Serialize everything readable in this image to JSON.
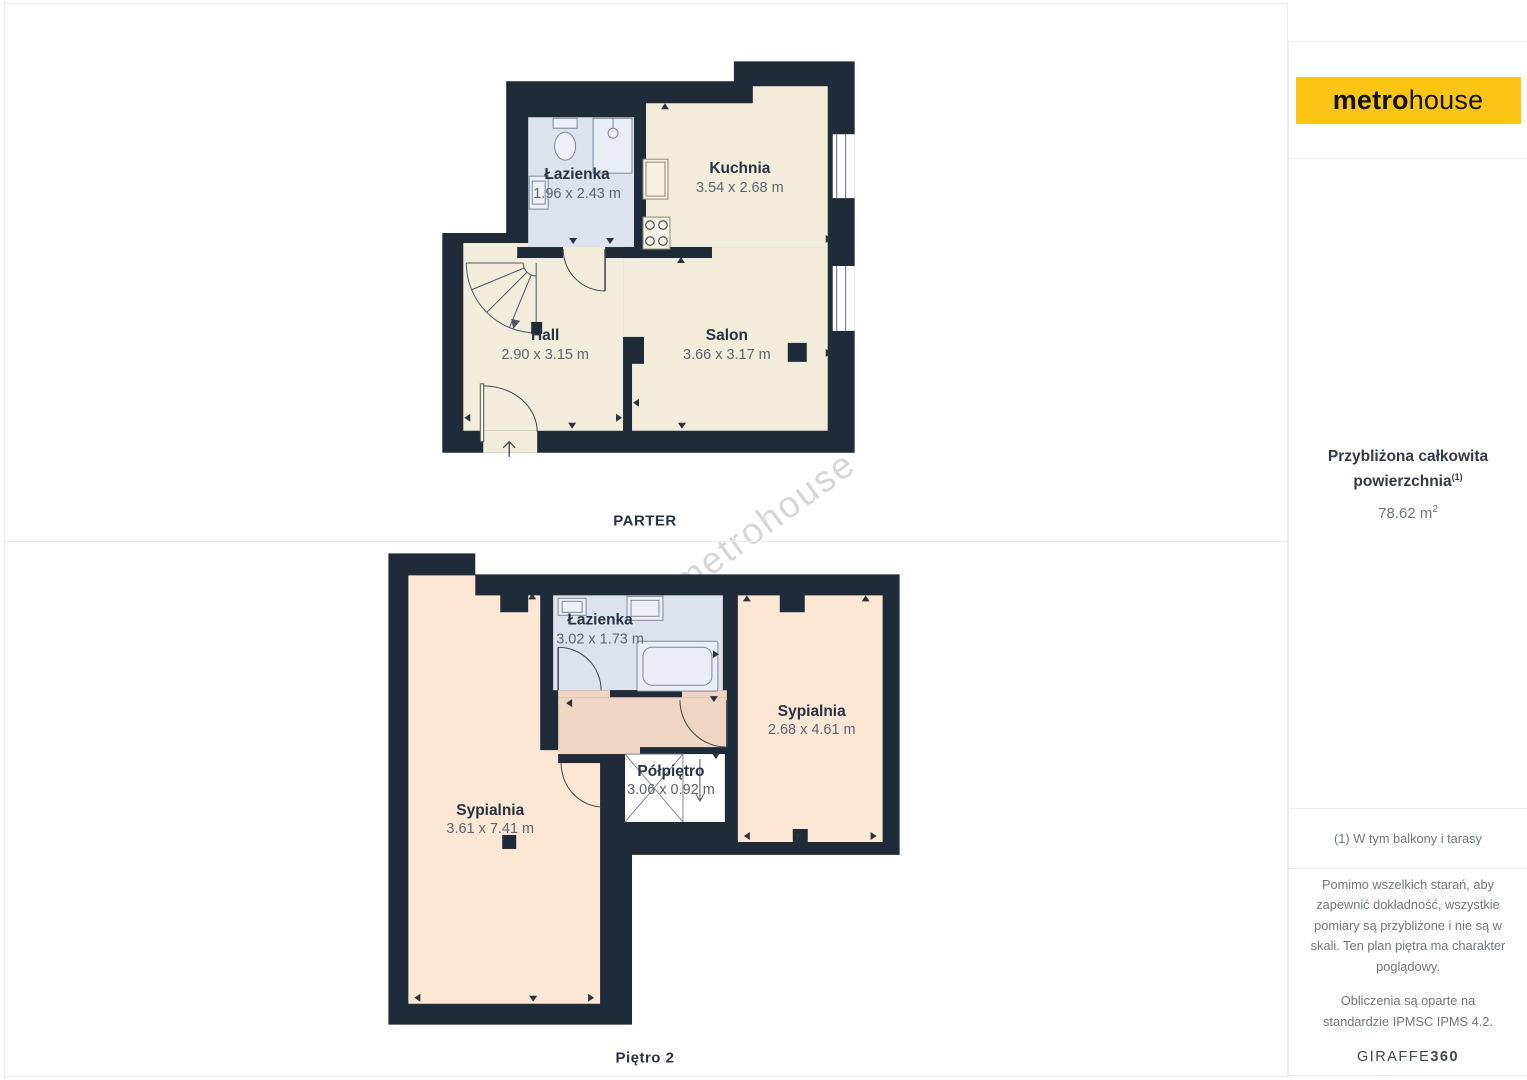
{
  "floors": {
    "parter": {
      "label": "PARTER",
      "rooms": [
        {
          "name": "Łazienka",
          "dims": "1.96 x 2.43 m"
        },
        {
          "name": "Kuchnia",
          "dims": "3.54 x 2.68 m"
        },
        {
          "name": "Hall",
          "dims": "2.90 x 3.15 m"
        },
        {
          "name": "Salon",
          "dims": "3.66 x 3.17 m"
        }
      ]
    },
    "pietro2": {
      "label": "Piętro 2",
      "rooms": [
        {
          "name": "Łazienka",
          "dims": "3.02 x 1.73 m"
        },
        {
          "name": "Sypialnia",
          "dims": "2.68 x 4.61 m"
        },
        {
          "name": "Półpiętro",
          "dims": "3.06 x 0.92 m"
        },
        {
          "name": "Sypialnia",
          "dims": "3.61 x 7.41 m"
        }
      ]
    }
  },
  "watermark": "metrohouse",
  "sidebar": {
    "logo": {
      "bold": "metro",
      "light": "house"
    },
    "area": {
      "title_line1": "Przybliżona całkowita",
      "title_line2": "powierzchnia",
      "title_sup": "(1)",
      "value": "78.62 m",
      "value_sup": "2"
    },
    "footnote": "(1) W tym balkony i tarasy",
    "disclaimer_scale": "Pomimo wszelkich starań, aby zapewnić dokładność, wszystkie pomiary są przybliżone i nie są w skali. Ten plan piętra ma charakter poglądowy.",
    "disclaimer_standard": "Obliczenia są oparte na standardzie IPMSC IPMS 4.2.",
    "brand": {
      "normal": "GIRAFFE",
      "bold": "360"
    }
  },
  "colors": {
    "wall": "#202b39",
    "floor_cream": "#f2edda",
    "floor_blue": "#dde3ee",
    "floor_peach": "#fbe7d4",
    "floor_salmon": "#f0d5c3",
    "logo_yellow": "#fdc513"
  }
}
